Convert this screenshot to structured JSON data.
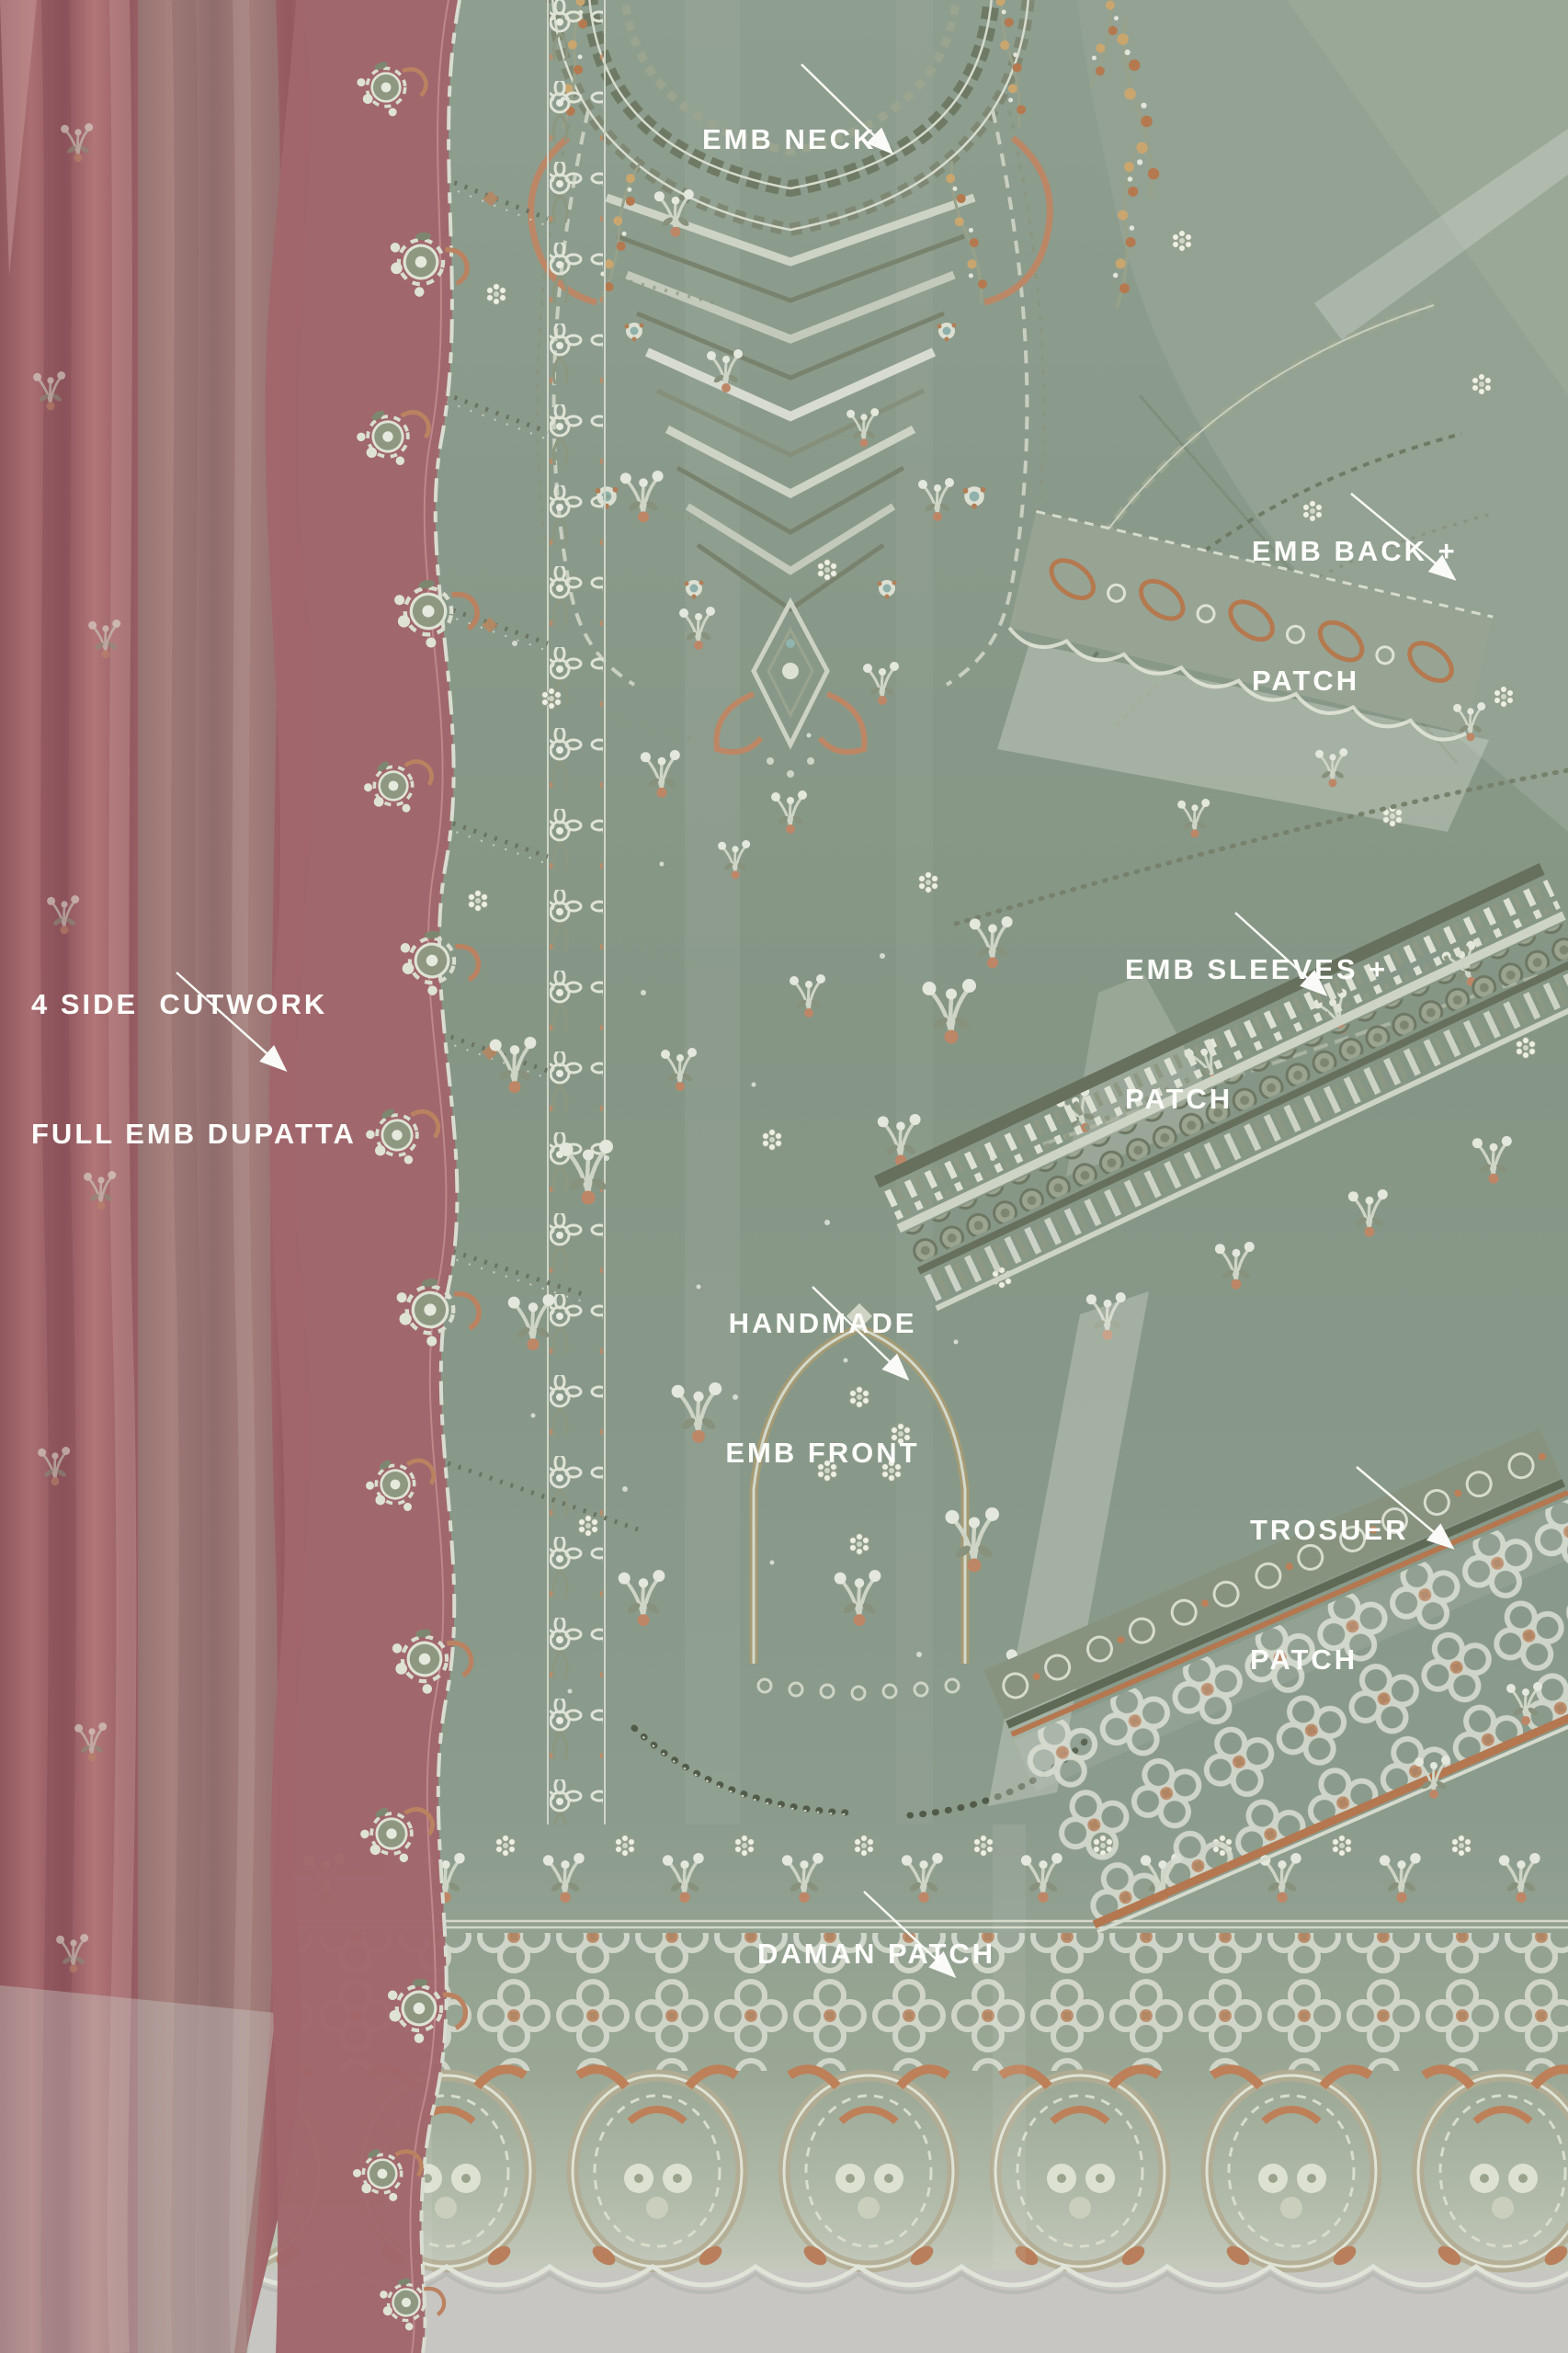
{
  "scene": {
    "kind": "product-photo",
    "colors": {
      "fabric_green": "#8B9B8C",
      "dupatta_pink": "#A3696D",
      "embroidery_silver": "#D8DDD0",
      "embroidery_copper": "#BD8462",
      "embroidery_olive": "#6F7A65",
      "surface_gray": "#C7C6C2",
      "label_text": "#FFFFFF"
    }
  },
  "annotations": [
    {
      "id": "emb-neck",
      "lines": [
        "EMB NECK"
      ],
      "arrow": "down-right"
    },
    {
      "id": "emb-back-patch",
      "lines": [
        "EMB BACK +",
        "PATCH"
      ],
      "arrow": "down-right"
    },
    {
      "id": "cutwork-dupatta",
      "lines": [
        "4 SIDE  CUTWORK",
        "FULL EMB DUPATTA"
      ],
      "arrow": "down-right"
    },
    {
      "id": "emb-sleeves-patch",
      "lines": [
        "EMB SLEEVES +",
        "PATCH"
      ],
      "arrow": "down-right"
    },
    {
      "id": "handmade-emb-front",
      "lines": [
        "HANDMADE",
        "EMB FRONT"
      ],
      "arrow": "down-right"
    },
    {
      "id": "trouser-patch",
      "lines": [
        "TROSUER",
        "PATCH"
      ],
      "arrow": "down-right"
    },
    {
      "id": "daman-patch",
      "lines": [
        "DAMAN PATCH"
      ],
      "arrow": "down-right"
    }
  ]
}
